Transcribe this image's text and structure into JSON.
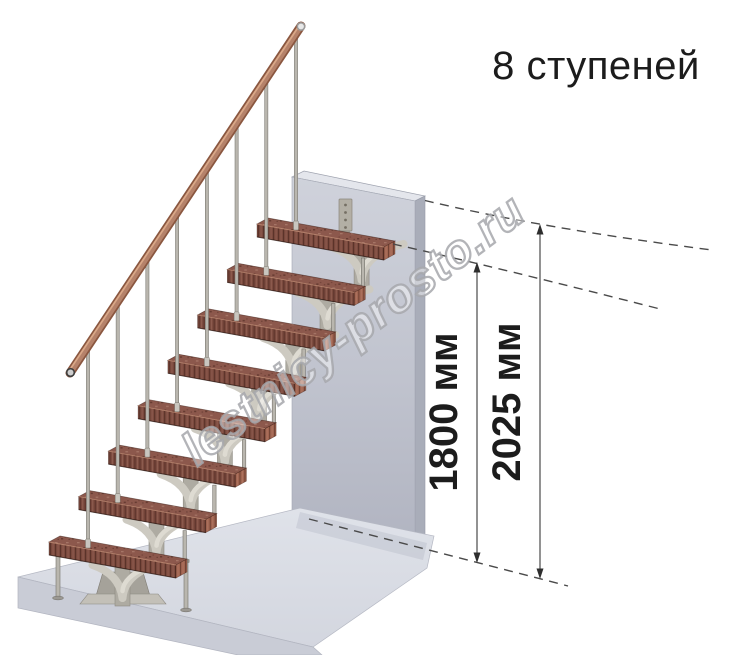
{
  "title": "8 ступеней",
  "steps_count": 8,
  "watermark": "lestnicy-prosto.ru",
  "dimensions": {
    "stair_height": {
      "label": "1800 мм",
      "value": 1800,
      "unit": "мм"
    },
    "floor_height": {
      "label": "2025 мм",
      "value": 2025,
      "unit": "мм"
    }
  },
  "colors": {
    "text": "#1c1c1c",
    "dim_line": "#4a4a4a",
    "watermark_stroke": "#a6a7ab",
    "tread_top": "#8c584c",
    "tread_front": "#7b4a3e",
    "tread_end": "#a06450",
    "rail": "#b5826a",
    "rail_dark": "#8a5740",
    "rail_light": "#dfae8c",
    "metal": "#b9b6ae",
    "metal_dark": "#76736c",
    "support": "#cdcac1",
    "support_dark": "#aeaba2",
    "wall_top": "#e4e6ec",
    "wall_side": "#a9adb9",
    "wall_front_top": "#cfd2db",
    "wall_front_bottom": "#b1b4c1",
    "platform_top": "#dcdfe7",
    "platform_front": "#c9ccd6"
  }
}
